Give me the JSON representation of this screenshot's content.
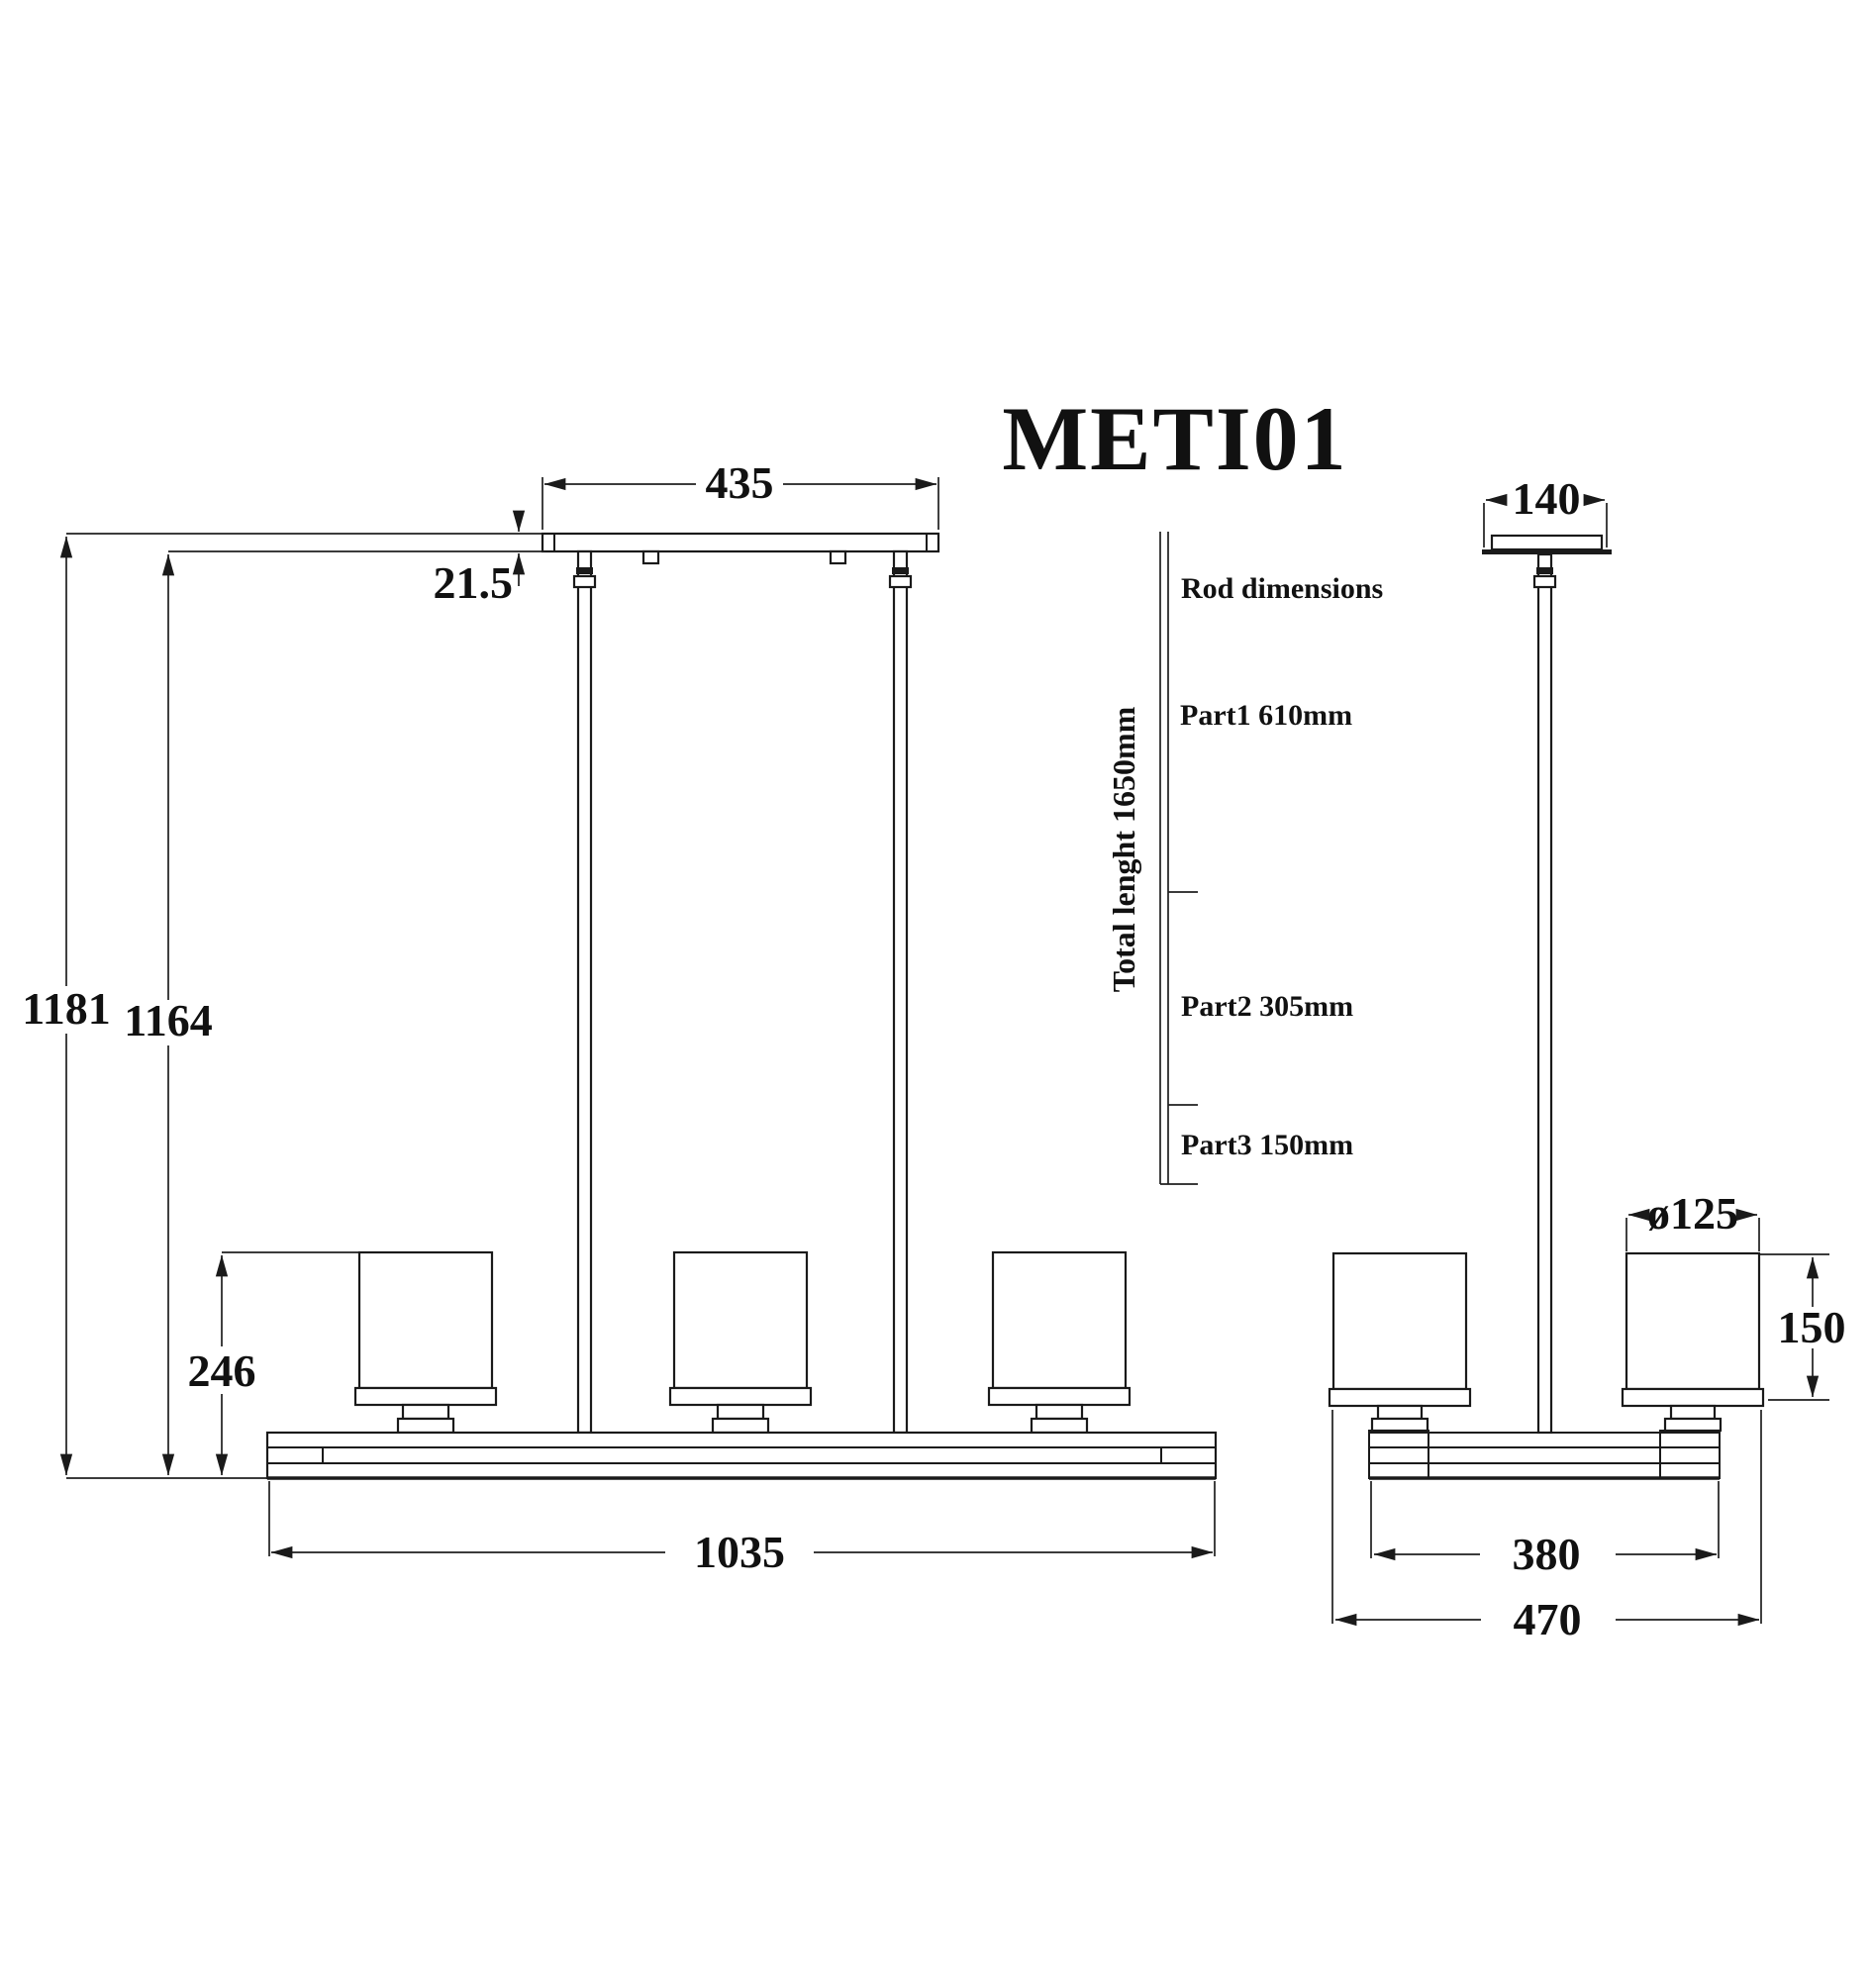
{
  "title": "METI01",
  "front_view": {
    "dims": {
      "canopy_width": "435",
      "canopy_thickness": "21.5",
      "overall_drop": "1181",
      "drop_below_canopy": "1164",
      "shade_to_beam_height": "246",
      "beam_length": "1035"
    }
  },
  "side_view": {
    "dims": {
      "canopy_depth": "140",
      "shade_diameter": "ø125",
      "shade_height": "150",
      "beam_depth": "380",
      "overall_depth": "470"
    }
  },
  "rod_table": {
    "heading": "Rod dimensions",
    "total_length": "Total lenght 1650mm",
    "parts": [
      {
        "label": "Part1 610mm"
      },
      {
        "label": "Part2 305mm"
      },
      {
        "label": "Part3 150mm"
      }
    ]
  }
}
